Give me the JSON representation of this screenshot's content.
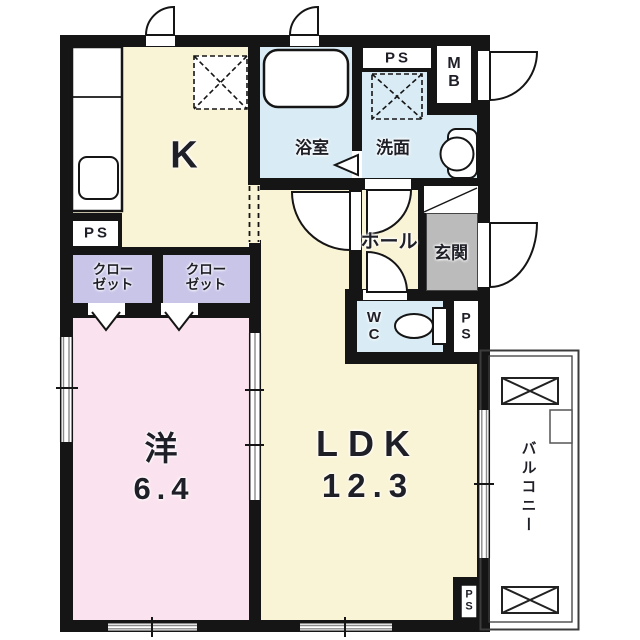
{
  "title": "apartment-floor-plan",
  "rooms": {
    "kitchen": {
      "label": "K"
    },
    "ldk": {
      "label": "LDK",
      "size": "12.3"
    },
    "western": {
      "label": "洋",
      "size": "6.4"
    },
    "bathroom": {
      "label": "浴室"
    },
    "washroom": {
      "label": "洗面"
    },
    "hall": {
      "label": "ホール"
    },
    "entrance": {
      "label": "玄関"
    },
    "toilet": {
      "line1": "W",
      "line2": "C"
    },
    "meter_box": {
      "line1": "M",
      "line2": "B"
    },
    "closet1": {
      "line1": "クロー",
      "line2": "ゼット"
    },
    "closet2": {
      "line1": "クロー",
      "line2": "ゼット"
    },
    "balcony": {
      "label": "バルコニー"
    }
  },
  "ps": {
    "top_left": "PS",
    "top": "PS",
    "mid_line1": "P",
    "mid_line2": "S",
    "bottom_line1": "P",
    "bottom_line2": "S"
  },
  "colors": {
    "wall": "#151515",
    "floor-cream": "#FAF4D6",
    "floor-pink": "#FAE3EE",
    "floor-purple": "#C8C5E9",
    "floor-blue": "#D9ECF5",
    "floor-gray": "#BBBBBB",
    "balcony-line": "#3C3C3C",
    "window-line": "#8A8A8A",
    "text": "#1F1F28"
  }
}
